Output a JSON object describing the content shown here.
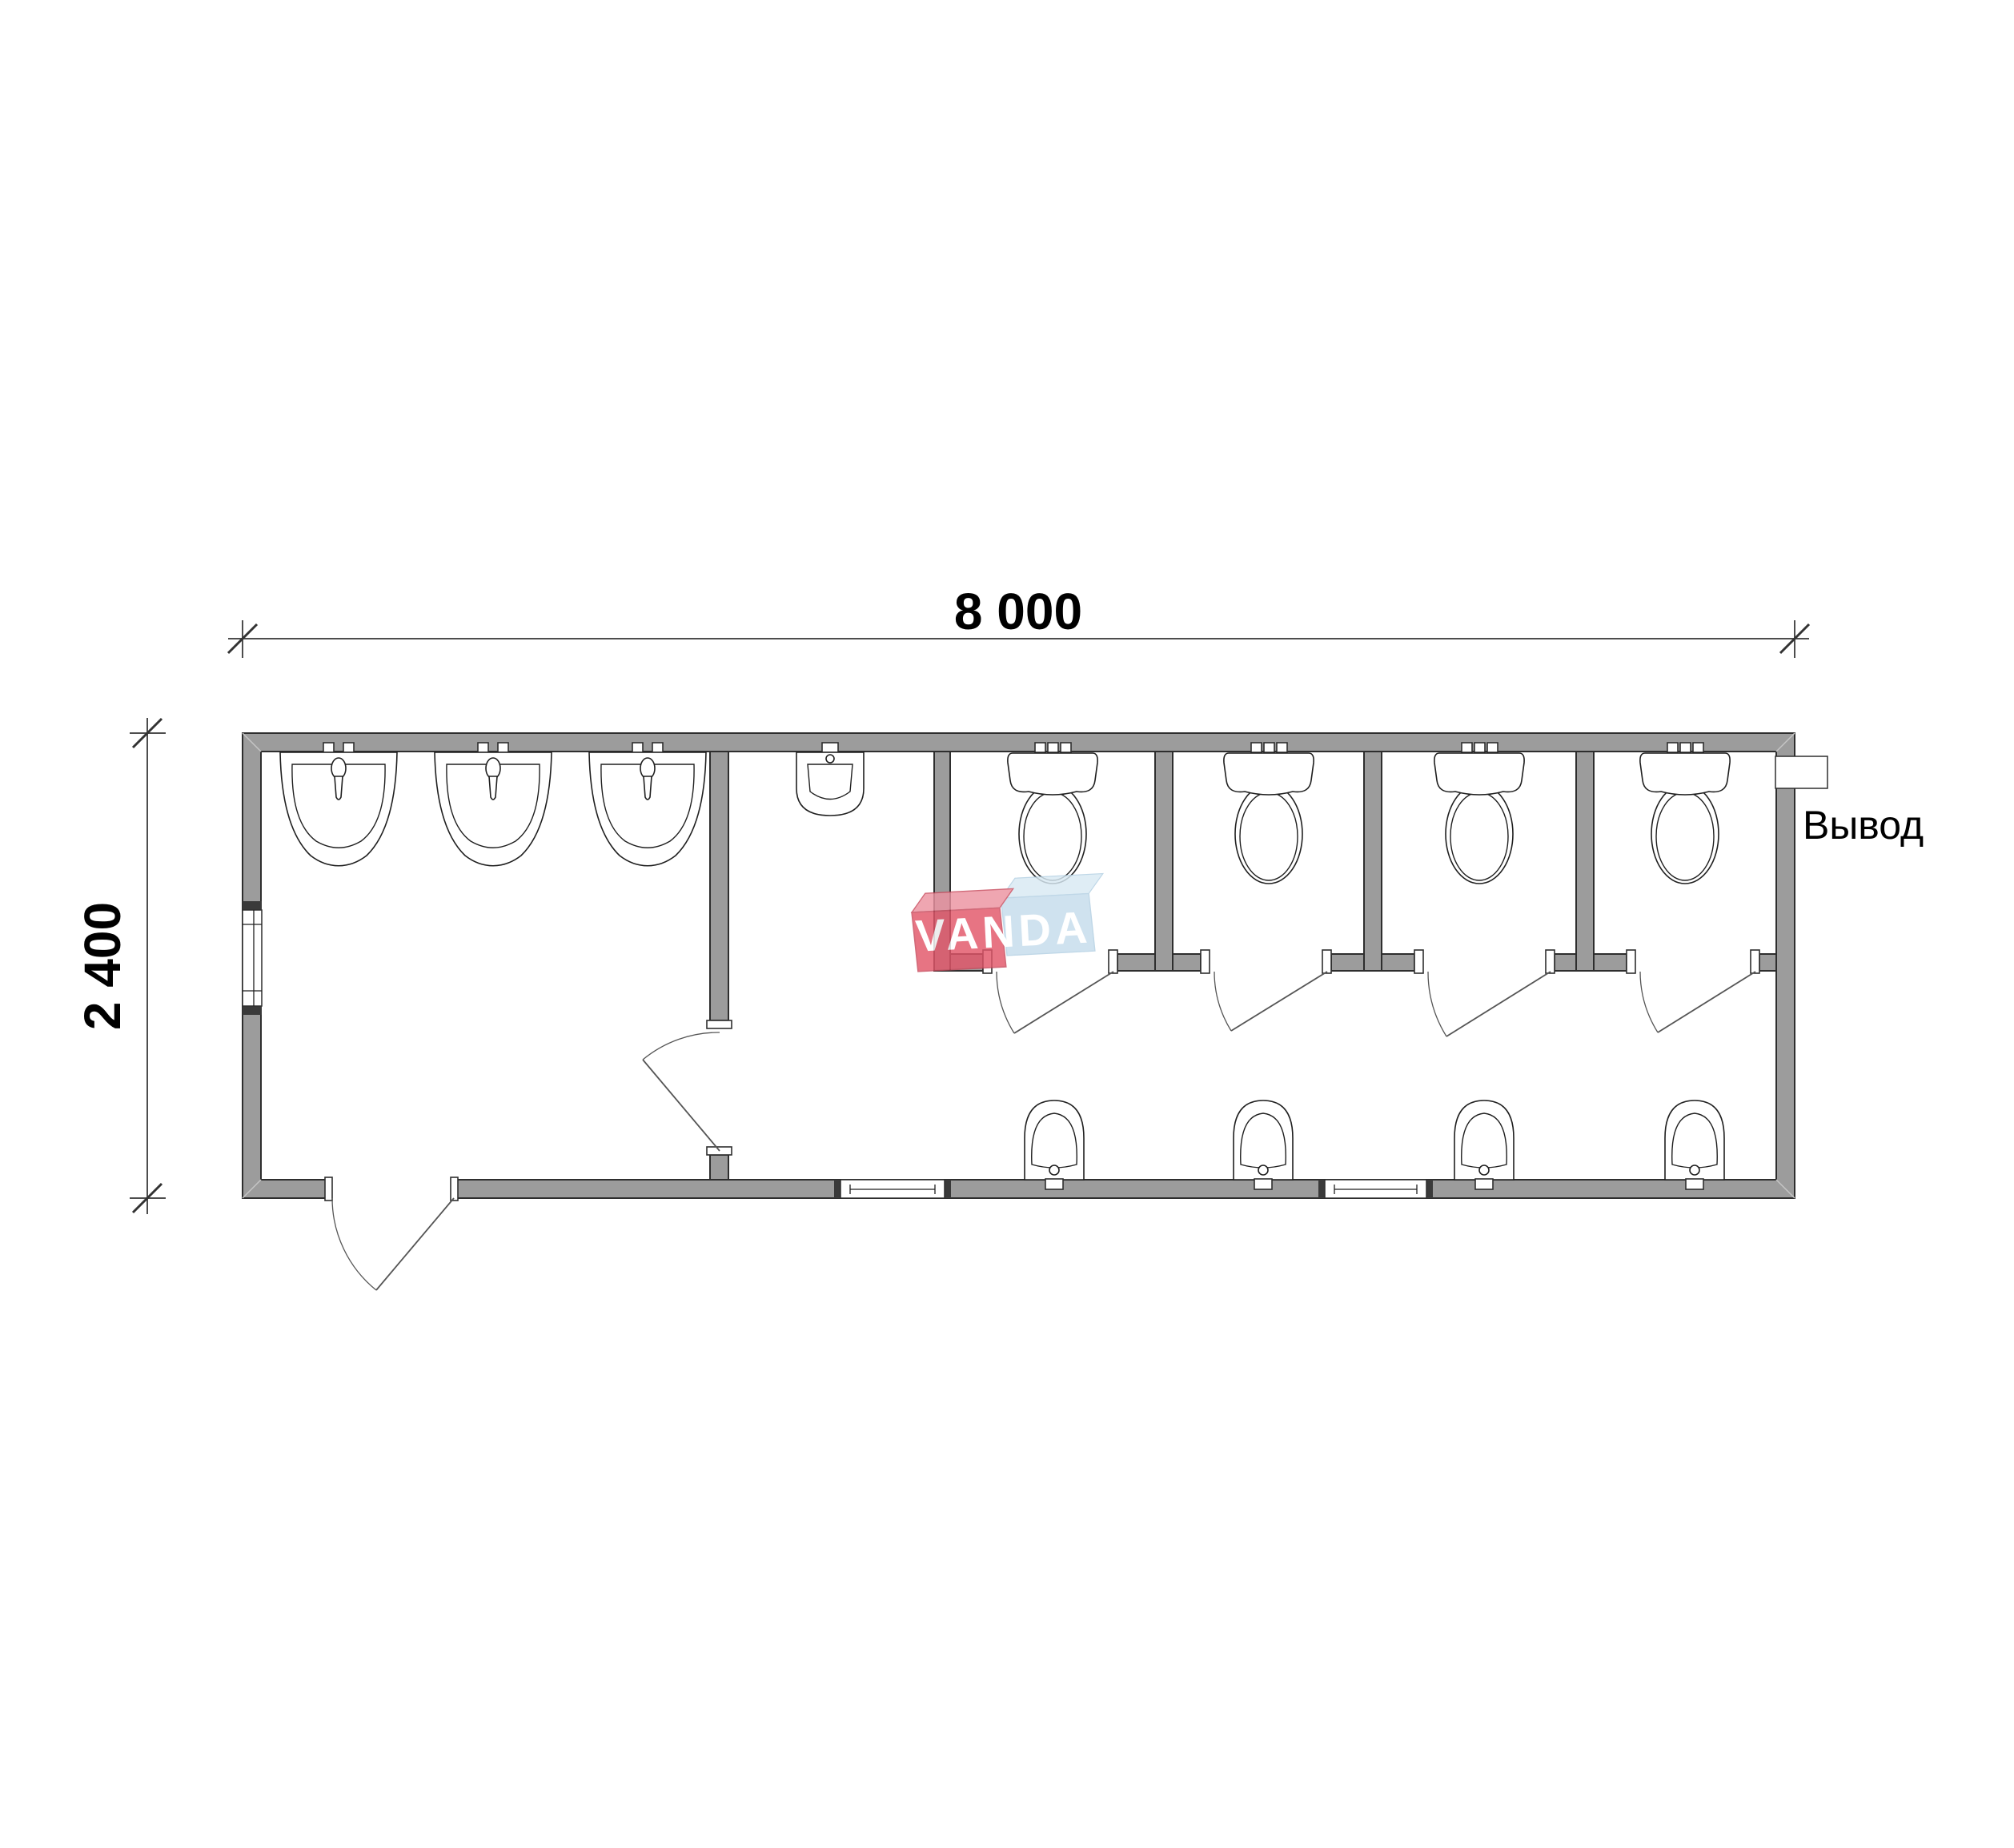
{
  "dimensions": {
    "width": {
      "label": "8 000"
    },
    "height": {
      "label": "2 400"
    }
  },
  "annotations": {
    "outlet_label": "Вывод"
  },
  "watermark": {
    "brand": "VANDA"
  },
  "colors": {
    "wall_fill": "#9c9c9c",
    "wall_edge": "#2e2e2e",
    "fixture_line": "#1f1f1f",
    "door_line": "#555555",
    "dimension_line": "#4d4d4d",
    "text": "#000000",
    "watermark_red_front": "#e25669",
    "watermark_red_top": "#ec93a1",
    "watermark_blue_front": "#c5dcec",
    "watermark_blue_top": "#d9eaf4",
    "watermark_text": "#ffffff",
    "background": "#ffffff"
  },
  "fixtures": {
    "washbasins_count": 3,
    "toilets_count": 4,
    "toilet_stalls_count": 4,
    "wall_urinals_top_count": 1,
    "wall_urinals_bottom_count": 4,
    "windows_count": 3,
    "doors_count": 6
  }
}
